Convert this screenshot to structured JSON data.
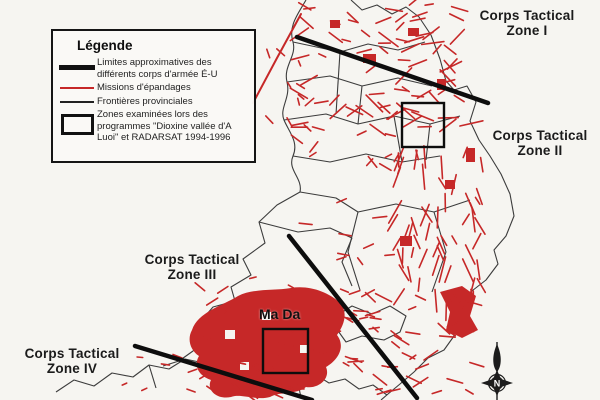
{
  "colors": {
    "spray": "#c62828",
    "boundary": "#0d0d0d",
    "province": "#3c3c3c",
    "paper": "#f6f5f1"
  },
  "legend": {
    "title": "Légende",
    "items": [
      {
        "symbol": "corps-boundary-thick-line",
        "label": "Limites approximatives des différents corps d'armée É-U"
      },
      {
        "symbol": "spray-mission-red-line",
        "label": "Missions d'épandages"
      },
      {
        "symbol": "province-border-thin-line",
        "label": "Frontières provinciales"
      },
      {
        "symbol": "examined-zone-rectangle",
        "label": "Zones examinées lors des programmes \"Dioxine vallée d'A Luoi\" et RADARSAT 1994-1996"
      }
    ]
  },
  "map": {
    "zone_labels": [
      {
        "id": "zone-1",
        "text": "Corps Tactical\nZone I"
      },
      {
        "id": "zone-2",
        "text": "Corps Tactical\nZone II"
      },
      {
        "id": "zone-3",
        "text": "Corps Tactical\nZone III"
      },
      {
        "id": "zone-4",
        "text": "Corps Tactical\nZone IV"
      }
    ],
    "place_labels": [
      {
        "id": "ma-da",
        "text": "Ma Da"
      }
    ],
    "compass": {
      "label": "N"
    }
  }
}
